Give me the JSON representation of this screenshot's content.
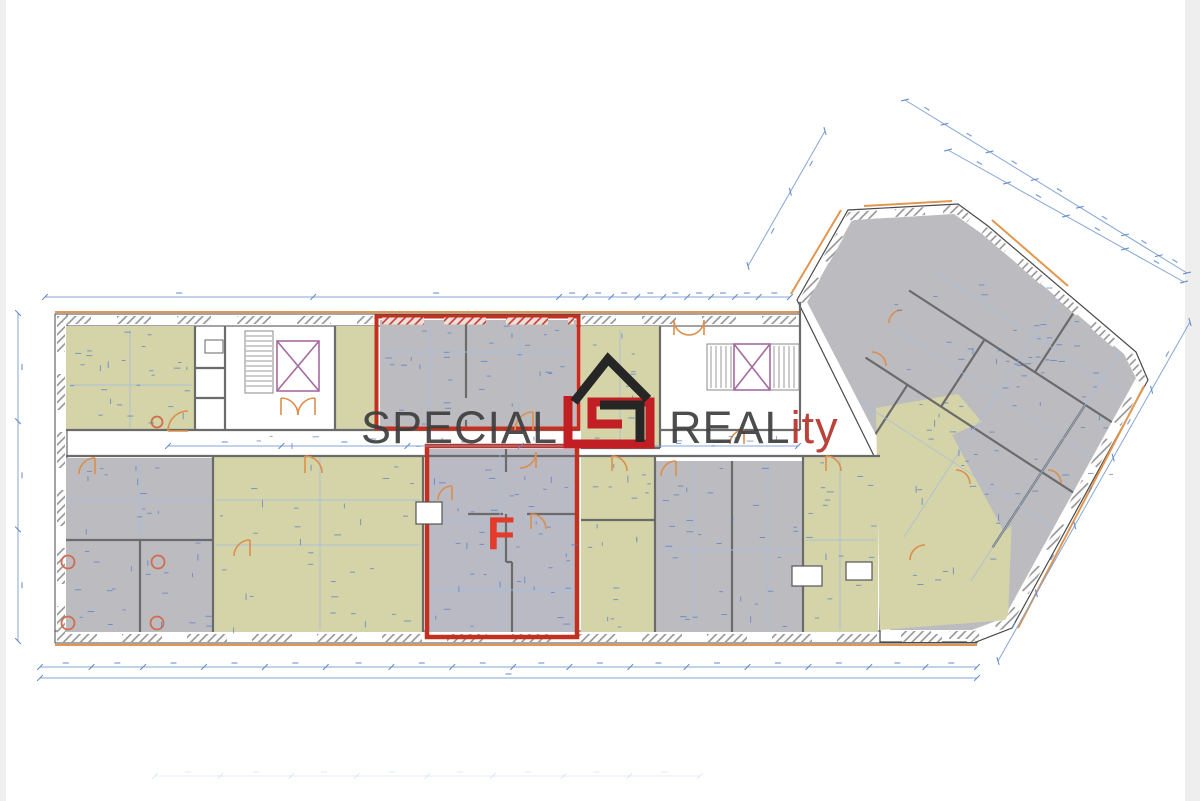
{
  "watermark": {
    "word_left": "SPECIAL",
    "word_right": "REAL",
    "word_right_accent": "ity"
  },
  "floor_plan": {
    "highlighted_unit_label": "F"
  },
  "colors": {
    "watermark_text": "#3e3e3e",
    "watermark_accent": "#b5322a",
    "logo_red": "#c21f24",
    "logo_black": "#262626",
    "highlight_red": "#c4301f",
    "unit_label_red": "#e23b2c",
    "room_fill_beige": "#d5d3a8",
    "room_fill_gray": "#bcbcc0",
    "dimension_blue": "#7ea2d4",
    "window_accent_orange": "#e2964f",
    "elevator_purple": "#a46ba0",
    "wall_outline_gray": "#4a4a4a"
  }
}
